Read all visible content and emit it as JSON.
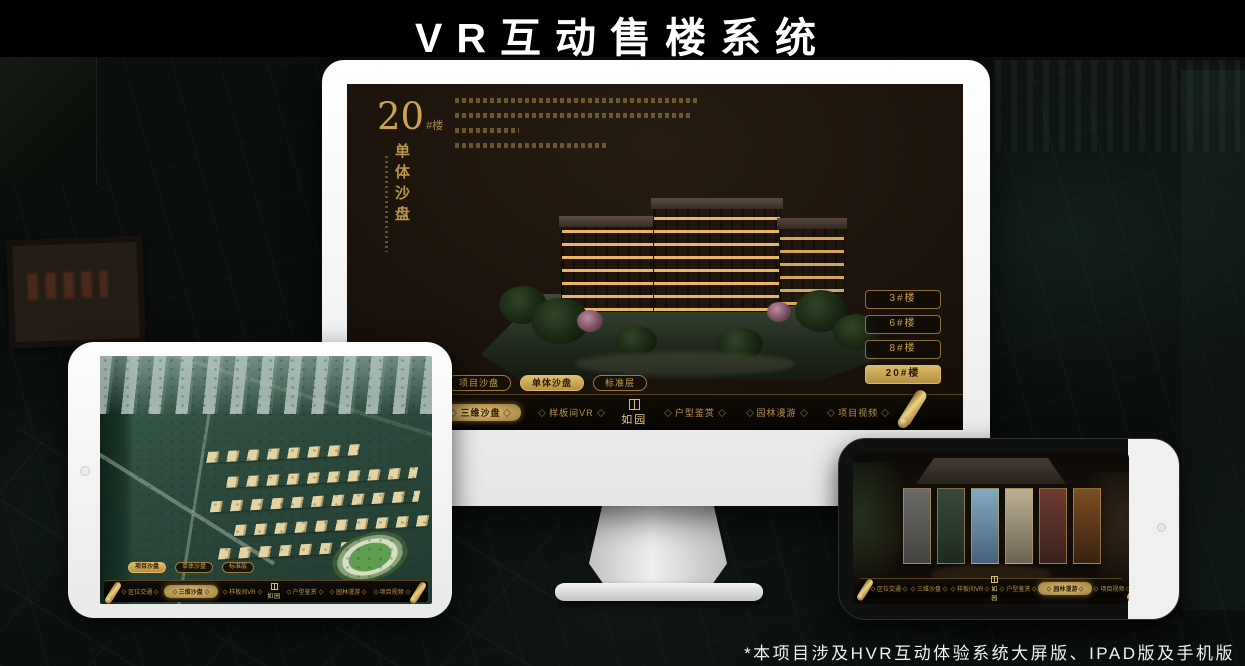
{
  "page": {
    "title": "VR互动售楼系统",
    "footnote": "*本项目涉及HVR互动体验系统大屏版、IPAD版及手机版"
  },
  "colors": {
    "gold": "#c9a352",
    "gold_bright": "#e6c678",
    "gold_dark": "#8a6f3a",
    "screen_bg": "#170f09",
    "nav_bg": "#0a0704",
    "white_frame": "#f2f2f2"
  },
  "desktop_screen": {
    "heading": {
      "number": "20",
      "suffix": "#楼",
      "subtitle_vertical": "单体沙盘"
    },
    "floor_buttons": [
      {
        "label": "3#楼",
        "active": false
      },
      {
        "label": "6#楼",
        "active": false
      },
      {
        "label": "8#楼",
        "active": false
      },
      {
        "label": "20#楼",
        "active": true
      }
    ],
    "tabs": [
      {
        "label": "项目沙盘",
        "active": false
      },
      {
        "label": "单体沙盘",
        "active": true
      },
      {
        "label": "标准层",
        "active": false
      }
    ],
    "nav": {
      "logo": "如园",
      "items": [
        {
          "label": "区位交通",
          "active": false
        },
        {
          "label": "三维沙盘",
          "active": true
        },
        {
          "label": "样板间VR",
          "active": false
        },
        {
          "label": "户型鉴赏",
          "active": false
        },
        {
          "label": "园林漫游",
          "active": false
        },
        {
          "label": "项目视频",
          "active": false
        }
      ]
    }
  },
  "tablet_screen": {
    "tabs": [
      {
        "label": "项目沙盘",
        "active": true
      },
      {
        "label": "单体沙盘",
        "active": false
      },
      {
        "label": "标准层",
        "active": false
      }
    ],
    "nav": {
      "logo": "如园",
      "items": [
        {
          "label": "区位交通",
          "active": false
        },
        {
          "label": "三维沙盘",
          "active": true
        },
        {
          "label": "样板间VR",
          "active": false
        },
        {
          "label": "户型鉴赏",
          "active": false
        },
        {
          "label": "园林漫游",
          "active": false
        },
        {
          "label": "项目视频",
          "active": false
        }
      ]
    }
  },
  "phone_screen": {
    "nav": {
      "logo": "如园",
      "items": [
        {
          "label": "区位交通",
          "active": false
        },
        {
          "label": "三维沙盘",
          "active": false
        },
        {
          "label": "样板间VR",
          "active": false
        },
        {
          "label": "户型鉴赏",
          "active": false
        },
        {
          "label": "园林漫游",
          "active": true
        },
        {
          "label": "项目视频",
          "active": false
        }
      ]
    }
  }
}
